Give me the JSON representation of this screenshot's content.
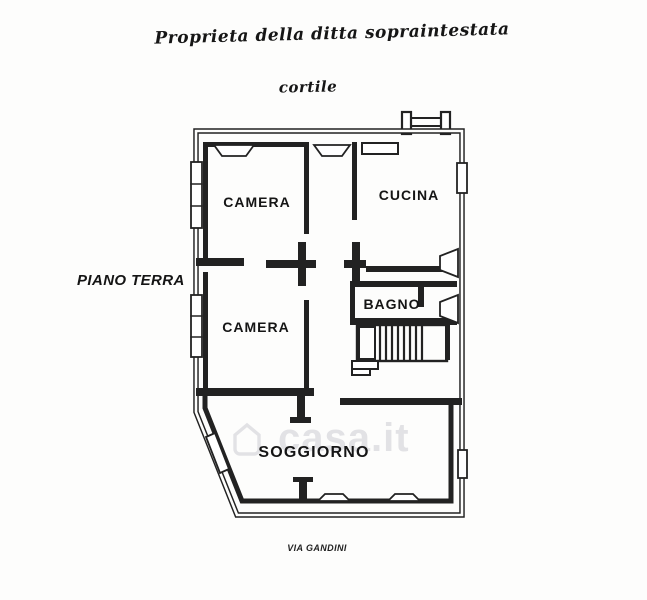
{
  "canvas": {
    "width": 647,
    "height": 600,
    "background": "#fdfdfc",
    "ink_color": "#1f1f1f",
    "watermark_color": "#ccccd3"
  },
  "annotations": {
    "property_note": "Proprieta della ditta sopraintestata",
    "courtyard": "cortile",
    "floor": "PIANO TERRA",
    "street": "VIA GANDINI"
  },
  "rooms": [
    {
      "id": "camera-top",
      "label": "CAMERA"
    },
    {
      "id": "cucina",
      "label": "CUCINA"
    },
    {
      "id": "camera-middle",
      "label": "CAMERA"
    },
    {
      "id": "bagno",
      "label": "BAGNO"
    },
    {
      "id": "soggiorno",
      "label": "SOGGIORNO"
    }
  ],
  "watermark": {
    "text": "casa.it"
  }
}
